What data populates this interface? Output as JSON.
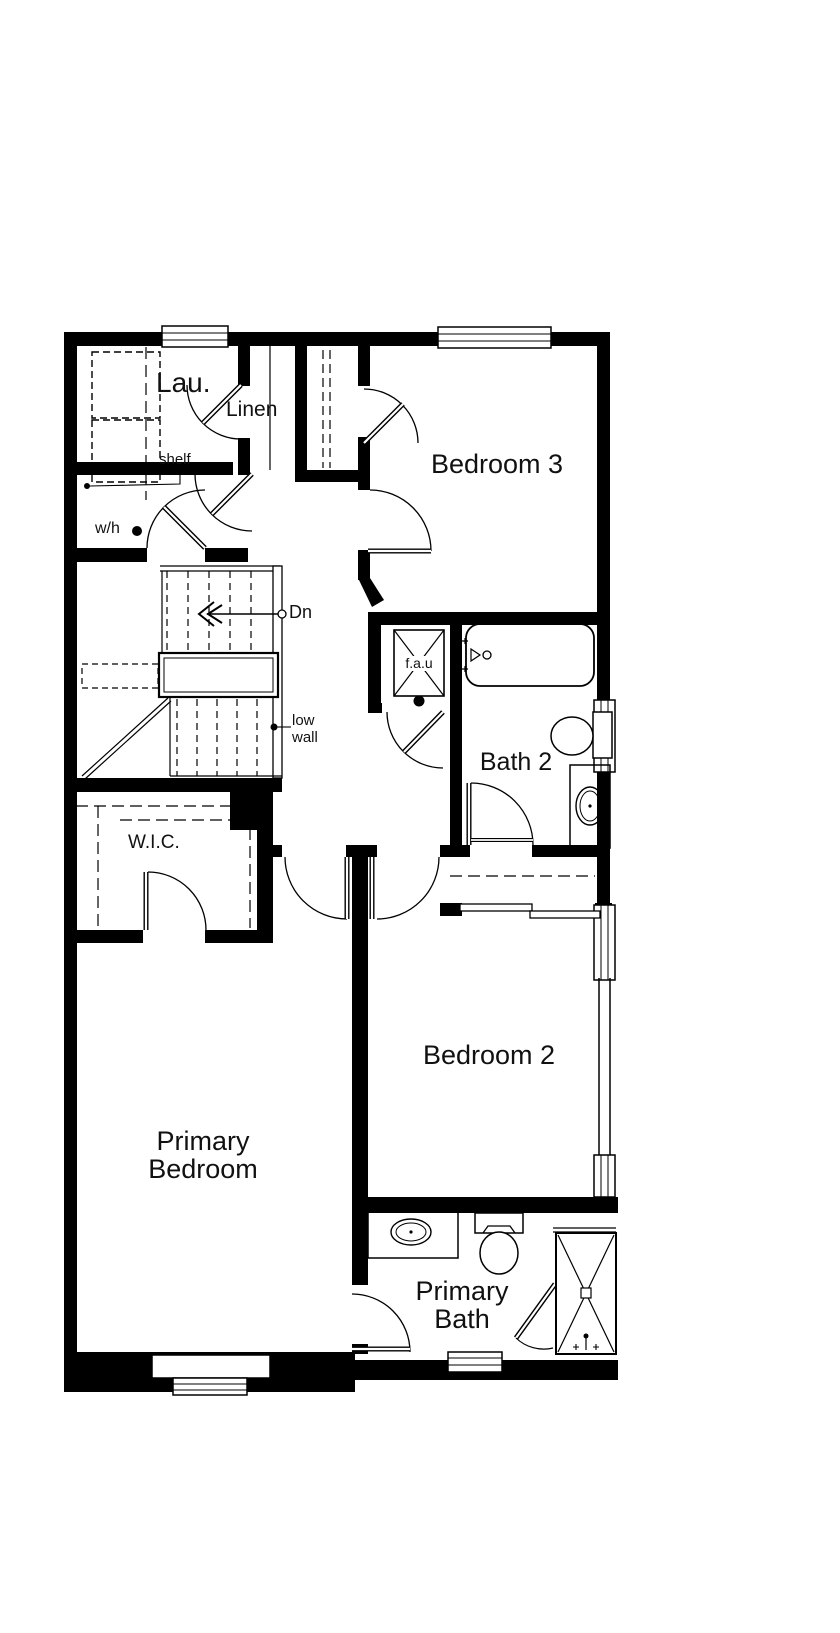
{
  "title": "Floor plan - second floor",
  "colors": {
    "wall": "#000000",
    "background": "#ffffff",
    "line": "#1a1a1a"
  },
  "rooms": {
    "laundry": {
      "label": "Lau."
    },
    "linen": {
      "label": "Linen"
    },
    "bedroom3": {
      "label": "Bedroom 3"
    },
    "bath2": {
      "label": "Bath 2"
    },
    "wic": {
      "label": "W.I.C."
    },
    "primary_bedroom": {
      "line1": "Primary",
      "line2": "Bedroom"
    },
    "bedroom2": {
      "label": "Bedroom 2"
    },
    "primary_bath": {
      "line1": "Primary",
      "line2": "Bath"
    }
  },
  "annotations": {
    "shelf": "shelf",
    "water_heater": "w/h",
    "stairs_down": "Dn",
    "low_wall_line1": "low",
    "low_wall_line2": "wall",
    "fau": "f.a.u"
  }
}
